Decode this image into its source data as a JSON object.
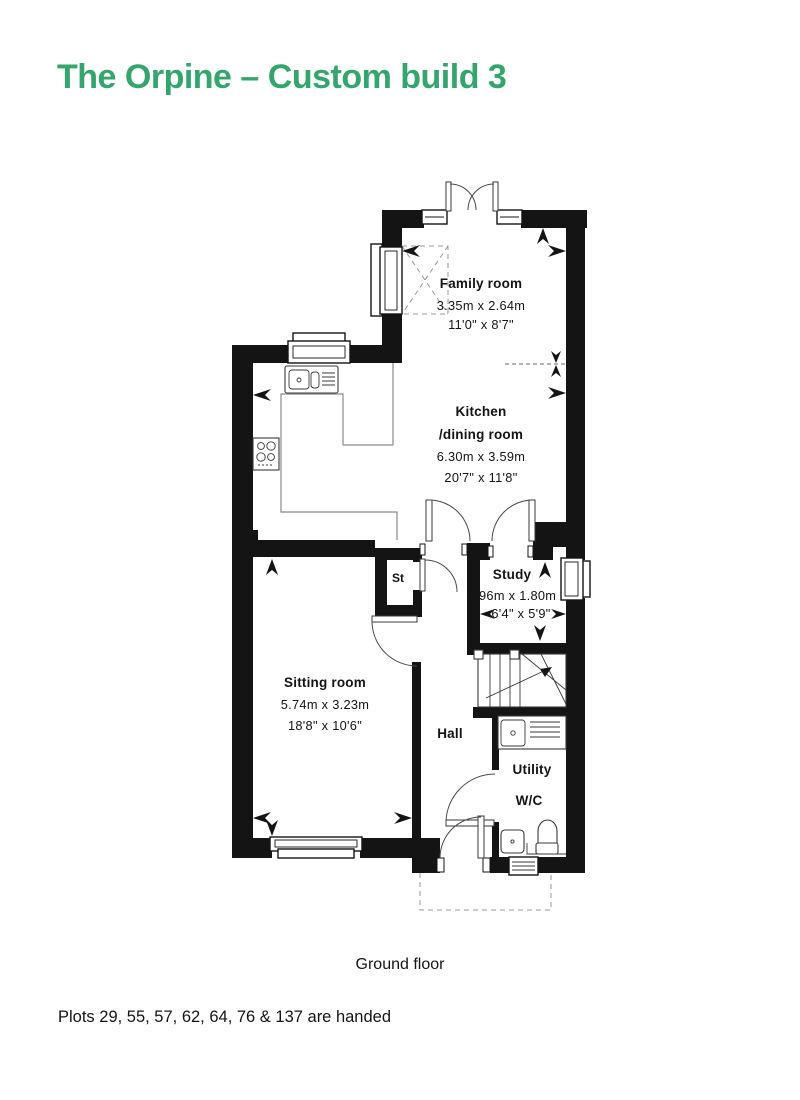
{
  "title": "The Orpine – Custom build 3",
  "colors": {
    "accent": "#34a56d",
    "wall": "#141414",
    "counter_line": "#8a8a8a"
  },
  "rooms": {
    "family": {
      "name": "Family room",
      "metric": "3.35m x 2.64m",
      "imperial": "11'0\" x 8'7\""
    },
    "kitchen": {
      "name": "Kitchen",
      "name2": "/dining room",
      "metric": "6.30m x 3.59m",
      "imperial": "20'7\" x 11'8\""
    },
    "study": {
      "name": "Study",
      "metric": "1.96m x 1.80m",
      "imperial": "6'4\" x 5'9\""
    },
    "sitting": {
      "name": "Sitting room",
      "metric": "5.74m x 3.23m",
      "imperial": "18'8\" x 10'6\""
    },
    "hall": {
      "name": "Hall"
    },
    "store": {
      "name": "St"
    },
    "utility": {
      "name": "Utility"
    },
    "wc": {
      "name": "W/C"
    }
  },
  "captions": {
    "floor": "Ground floor",
    "note": "Plots 29, 55, 57, 62, 64, 76 & 137 are handed"
  },
  "fixtures": [
    "kitchen-sink",
    "hob",
    "utility-sink",
    "toilet",
    "basin",
    "stairs",
    "rooflight",
    "porch-canopy"
  ]
}
